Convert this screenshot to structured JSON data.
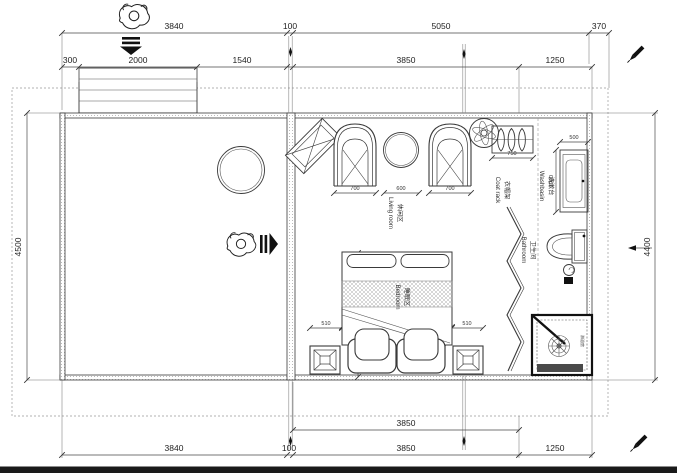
{
  "drawing_type": "residential floor plan",
  "colors": {
    "ink": "#3a3a3a",
    "dim_ink": "#4a4a4a",
    "footer_bar": "#1a1a1a",
    "paper": "#ffffff"
  },
  "dims": {
    "top1": [
      "3840",
      "100",
      "5050",
      "370"
    ],
    "top2": [
      "300",
      "2000",
      "1540",
      "3850",
      "1250"
    ],
    "left": "4500",
    "right": "4400",
    "bottom1": "3850",
    "bottom2": [
      "3840",
      "100",
      "3850",
      "1250"
    ],
    "living": [
      "700",
      "600",
      "700"
    ],
    "coat_rack": "750",
    "washbasin_w": "500",
    "washbasin_d": "1000",
    "bed_l": "2000",
    "bed_w": "1800",
    "bed_side_left": "510",
    "bed_side_right": "510"
  },
  "labels": {
    "living_zh": "休闲区",
    "living_en": "Living room",
    "coat_zh": "衣帽架",
    "coat_en": "Coat rack",
    "wash_zh": "洗漱台",
    "wash_en": "Washbasin",
    "bath_zh": "卫生间",
    "bath_en": "Bathroom",
    "bed_zh": "睡眠区",
    "bed_en": "Bedroom",
    "shower_zh": "淋浴房"
  }
}
